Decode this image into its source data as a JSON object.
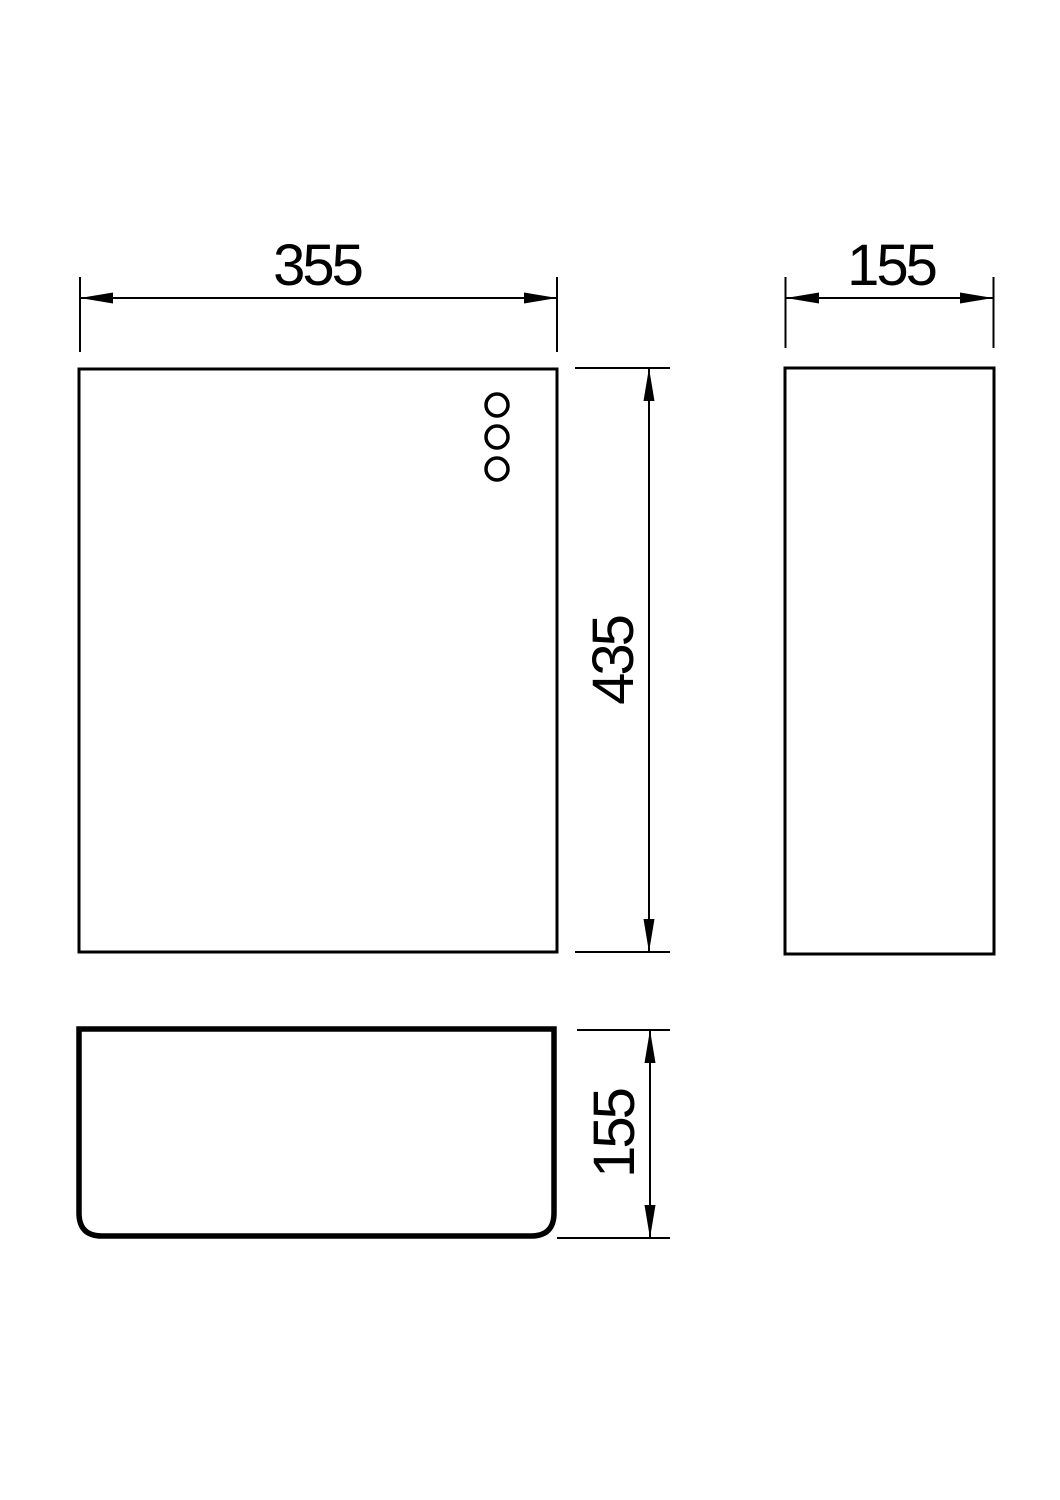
{
  "drawing": {
    "background_color": "#ffffff",
    "line_color": "#000000"
  },
  "dimensions": {
    "front_width": "355",
    "side_depth": "155",
    "front_height": "435",
    "plan_depth": "155"
  }
}
